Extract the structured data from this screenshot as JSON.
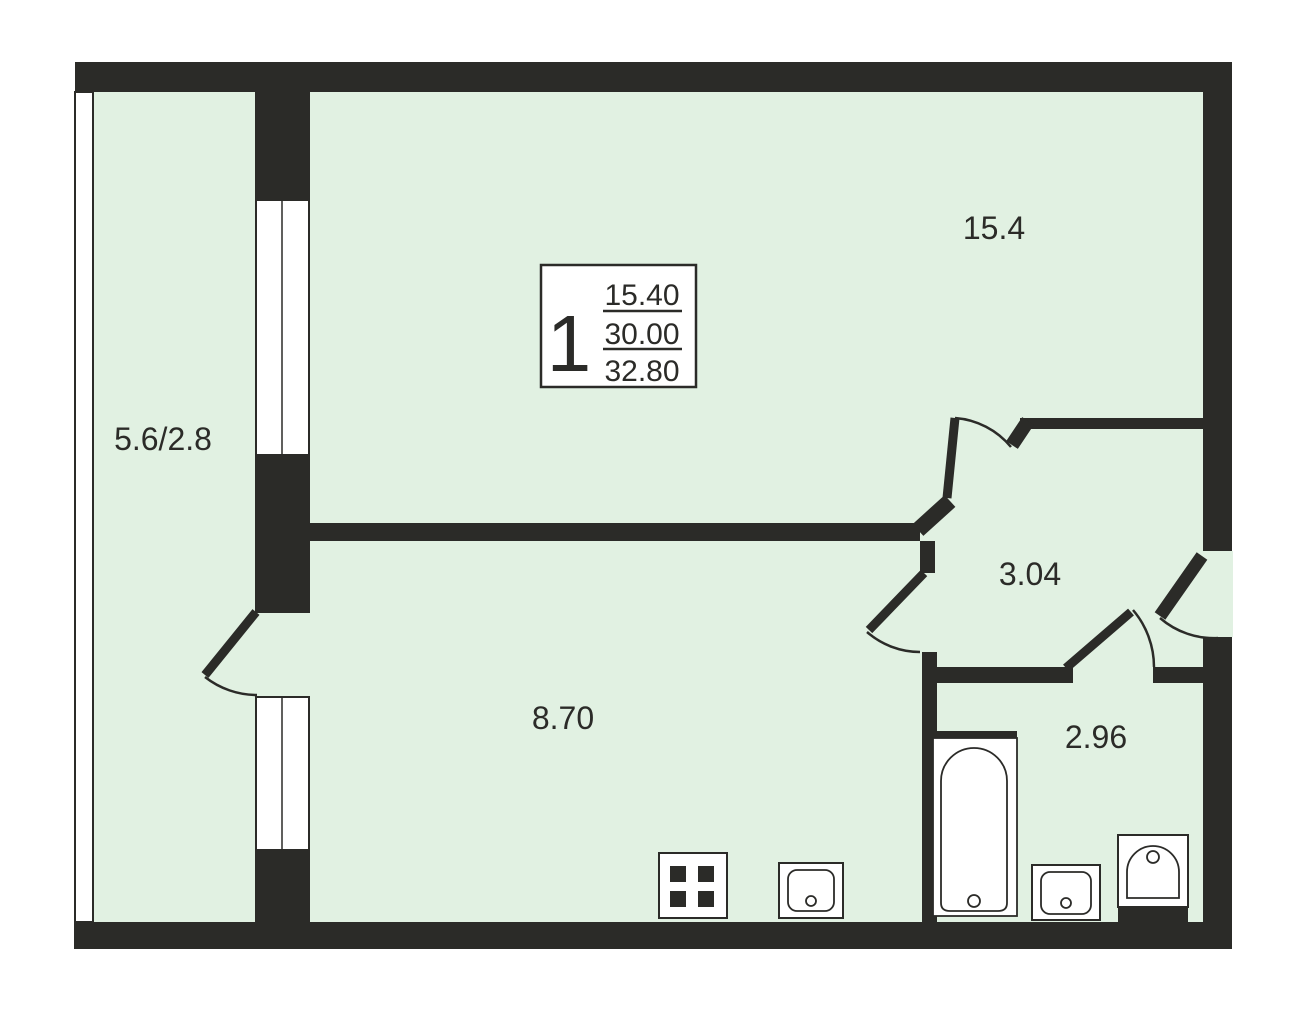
{
  "colors": {
    "wall": "#2b2b28",
    "floor": "#e1f1e2",
    "page": "#ffffff"
  },
  "stamp": {
    "rooms_count": "1",
    "living_area": "15.40",
    "total_area": "30.00",
    "overall_area": "32.80"
  },
  "rooms": {
    "living": {
      "area": "15.4"
    },
    "balcony": {
      "area": "5.6/2.8"
    },
    "hallway": {
      "area": "3.04"
    },
    "kitchen": {
      "area": "8.70"
    },
    "bathroom": {
      "area": "2.96"
    }
  },
  "fixtures": {
    "stove": "stove-icon",
    "kitchen_sink": "kitchen-sink-icon",
    "bathtub": "bathtub-icon",
    "bathroom_sink": "bathroom-sink-icon",
    "toilet": "toilet-icon"
  }
}
